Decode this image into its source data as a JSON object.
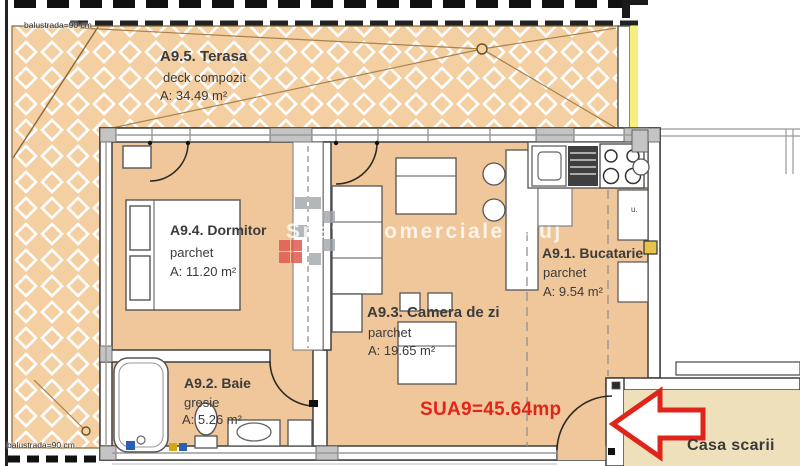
{
  "plan": {
    "watermark": {
      "text": "Spatii Comerciale Cluj"
    },
    "labels": {
      "total_area": "SUA9=45.64mp",
      "stairwell": "Casa scarii",
      "balustrade_top": "balustrada=90 cm",
      "balustrade_bottom": "balustrada=90 cm",
      "kitchen_unit_mark": "u."
    },
    "rooms": {
      "terrace": {
        "title": "A9.5. Terasa",
        "material": "deck compozit",
        "area": "A: 34.49 m²"
      },
      "bedroom": {
        "title": "A9.4. Dormitor",
        "material": "parchet",
        "area": "A: 11.20 m²"
      },
      "living": {
        "title": "A9.3. Camera de zi",
        "material": "parchet",
        "area": "A: 19.65 m²"
      },
      "kitchen": {
        "title": "A9.1. Bucatarie",
        "material": "parchet",
        "area": "A: 9.54 m²"
      },
      "bathroom": {
        "title": "A9.2. Baie",
        "material": "gresie",
        "area": "A: 5.26 m²"
      }
    },
    "colors": {
      "floor": "#f0c79b",
      "terrace": "#f3cfa2",
      "stairwell_bg": "#eee0bb",
      "wall_highlight": "#f6ef7d",
      "accent_red": "#df241c",
      "wall_gray": "#c4c4c4",
      "wall_outline": "#3f3f3f",
      "lattice_line": "#ffffff"
    }
  }
}
